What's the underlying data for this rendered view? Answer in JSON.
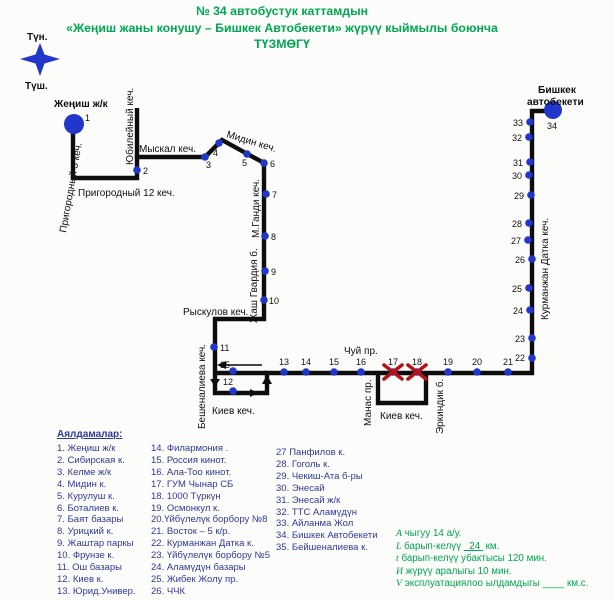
{
  "title": {
    "line1": "№ 34  автобустук каттамдын",
    "line2": "«Жеңиш жаны конушу – Бишкек Автобекети»  жүрүү кыймылы боюнча",
    "line3": "ТҮЗМӨГҮ"
  },
  "colors": {
    "green": "#00a651",
    "navy": "#2e3a98",
    "blue": "#2236cb",
    "ink": "#0d0d0d",
    "red": "#b5121b",
    "bg": "#fcfcfa"
  },
  "map": {
    "compass": {
      "north": "Түн.",
      "south": "Түш.",
      "nx": 27,
      "ny": 40,
      "sx": 25,
      "sy": 89,
      "star": "40,43 44.5,54.5 60,59 44.5,63.5 40,76 35.5,63.5 20,59 35.5,54.5"
    },
    "route_path": "M73,123 L73,178 L137,178 L137,157 L205,157 L222,140 L264,163 L264,319 L215,319 L215,393 L267,393 L267,373 L532,373 L532,111 L553,111",
    "street_segments": [
      "M137,108 L137,158",
      "M215,373 L267,373",
      "M378,373 L378,403 L426,403 L426,373"
    ],
    "thin_lines": [
      "M224,365 L262,365"
    ],
    "arrows": [
      {
        "points": "217,365 226,361 226,369",
        "name": "arrow-west-icon"
      },
      {
        "points": "215,387 210,379 220,379",
        "name": "arrow-south-icon"
      },
      {
        "points": "258,393 250,389 250,397",
        "name": "arrow-east-icon"
      },
      {
        "points": "267,375 262,384 272,384",
        "name": "arrow-north-icon"
      }
    ],
    "terminals": [
      {
        "n": "1",
        "x": 74,
        "y": 124,
        "r": 10,
        "nx": 85,
        "ny": 121,
        "a": "start"
      },
      {
        "n": "34",
        "x": 553,
        "y": 110,
        "r": 9,
        "nx": 552,
        "ny": 129,
        "a": "middle"
      }
    ],
    "stops": [
      {
        "n": "2",
        "x": 137,
        "y": 170,
        "nx": 143,
        "ny": 174,
        "a": "start"
      },
      {
        "n": "3",
        "x": 205,
        "y": 157,
        "nx": 206,
        "ny": 168,
        "a": "start"
      },
      {
        "n": "4",
        "x": 219,
        "y": 143,
        "nx": 213,
        "ny": 156,
        "a": "start"
      },
      {
        "n": "5",
        "x": 247,
        "y": 154,
        "nx": 242,
        "ny": 166,
        "a": "start"
      },
      {
        "n": "6",
        "x": 264,
        "y": 163,
        "nx": 270,
        "ny": 167,
        "a": "start"
      },
      {
        "n": "7",
        "x": 266,
        "y": 194,
        "nx": 272,
        "ny": 198,
        "a": "start"
      },
      {
        "n": "8",
        "x": 265,
        "y": 236,
        "nx": 271,
        "ny": 240,
        "a": "start"
      },
      {
        "n": "9",
        "x": 265,
        "y": 271,
        "nx": 271,
        "ny": 275,
        "a": "start"
      },
      {
        "n": "10",
        "x": 264,
        "y": 300,
        "nx": 269,
        "ny": 304,
        "a": "start"
      },
      {
        "n": "11",
        "x": 214,
        "y": 347,
        "nx": 220,
        "ny": 351,
        "a": "start"
      },
      {
        "n": "12",
        "x": 233,
        "y": 391,
        "nx": 223,
        "ny": 385,
        "a": "start"
      },
      {
        "n": "35",
        "x": 233,
        "y": 371,
        "nx": 220,
        "ny": 368,
        "a": "start"
      },
      {
        "n": "13",
        "x": 284,
        "y": 372,
        "nx": 284,
        "ny": 365,
        "a": "middle"
      },
      {
        "n": "14",
        "x": 306,
        "y": 372,
        "nx": 306,
        "ny": 365,
        "a": "middle"
      },
      {
        "n": "15",
        "x": 334,
        "y": 372,
        "nx": 334,
        "ny": 365,
        "a": "middle"
      },
      {
        "n": "16",
        "x": 361,
        "y": 372,
        "nx": 361,
        "ny": 365,
        "a": "middle"
      },
      {
        "n": "17",
        "x": 393,
        "y": 372,
        "nx": 393,
        "ny": 365,
        "a": "middle"
      },
      {
        "n": "18",
        "x": 417,
        "y": 372,
        "nx": 417,
        "ny": 365,
        "a": "middle"
      },
      {
        "n": "19",
        "x": 448,
        "y": 372,
        "nx": 448,
        "ny": 365,
        "a": "middle"
      },
      {
        "n": "20",
        "x": 477,
        "y": 372,
        "nx": 477,
        "ny": 365,
        "a": "middle"
      },
      {
        "n": "21",
        "x": 508,
        "y": 372,
        "nx": 508,
        "ny": 365,
        "a": "middle"
      },
      {
        "n": "22",
        "x": 532,
        "y": 358,
        "nx": 525,
        "ny": 361,
        "a": "end"
      },
      {
        "n": "23",
        "x": 532,
        "y": 338,
        "nx": 525,
        "ny": 342,
        "a": "end"
      },
      {
        "n": "24",
        "x": 530,
        "y": 310,
        "nx": 523,
        "ny": 314,
        "a": "end"
      },
      {
        "n": "25",
        "x": 529,
        "y": 288,
        "nx": 522,
        "ny": 292,
        "a": "end"
      },
      {
        "n": "26",
        "x": 532,
        "y": 259,
        "nx": 525,
        "ny": 263,
        "a": "end"
      },
      {
        "n": "27",
        "x": 528,
        "y": 240,
        "nx": 521,
        "ny": 244,
        "a": "end"
      },
      {
        "n": "28",
        "x": 529,
        "y": 223,
        "nx": 522,
        "ny": 227,
        "a": "end"
      },
      {
        "n": "29",
        "x": 531,
        "y": 195,
        "nx": 524,
        "ny": 199,
        "a": "end"
      },
      {
        "n": "30",
        "x": 529,
        "y": 175,
        "nx": 522,
        "ny": 179,
        "a": "end"
      },
      {
        "n": "31",
        "x": 530,
        "y": 162,
        "nx": 523,
        "ny": 166,
        "a": "end"
      },
      {
        "n": "32",
        "x": 529,
        "y": 137,
        "nx": 522,
        "ny": 141,
        "a": "end"
      },
      {
        "n": "33",
        "x": 530,
        "y": 122,
        "nx": 523,
        "ny": 126,
        "a": "end"
      }
    ],
    "crossed": [
      {
        "x": 393,
        "y": 372
      },
      {
        "x": 417,
        "y": 372
      }
    ],
    "street_labels": [
      {
        "t": "Жеңиш ж/к",
        "x": 54,
        "y": 107,
        "rot": 0,
        "bold": true
      },
      {
        "t": "Бишкек",
        "x": 538,
        "y": 93,
        "rot": 0,
        "bold": true
      },
      {
        "t": "автобекети",
        "x": 527,
        "y": 105,
        "rot": 0,
        "bold": true
      },
      {
        "t": "Пригородный 3 кеч.",
        "x": 66,
        "y": 233,
        "rot": -80,
        "bold": false
      },
      {
        "t": "Юбилейный кеч.",
        "x": 133,
        "y": 165,
        "rot": -90,
        "bold": false
      },
      {
        "t": "Пригородный 12 кеч.",
        "x": 78,
        "y": 196,
        "rot": 0,
        "bold": false
      },
      {
        "t": "Мыскал кеч.",
        "x": 139,
        "y": 152,
        "rot": 0,
        "bold": false
      },
      {
        "t": "Мидин кеч.",
        "x": 226,
        "y": 137,
        "rot": 17,
        "bold": false
      },
      {
        "t": "М.Ганди кеч.",
        "x": 259,
        "y": 238,
        "rot": -90,
        "bold": false
      },
      {
        "t": "Жаш Гвардия б.",
        "x": 257,
        "y": 323,
        "rot": -90,
        "bold": false
      },
      {
        "t": "Рыскулов кеч.",
        "x": 183,
        "y": 315,
        "rot": 0,
        "bold": false
      },
      {
        "t": "Бешеналиева кеч.",
        "x": 205,
        "y": 429,
        "rot": -90,
        "bold": false
      },
      {
        "t": "Киев кеч.",
        "x": 212,
        "y": 414,
        "rot": 0,
        "bold": false
      },
      {
        "t": "Чуй пр.",
        "x": 344,
        "y": 354,
        "rot": 0,
        "bold": false
      },
      {
        "t": "Манас пр.",
        "x": 371,
        "y": 426,
        "rot": -90,
        "bold": false
      },
      {
        "t": "Киев кеч.",
        "x": 380,
        "y": 419,
        "rot": 0,
        "bold": false
      },
      {
        "t": "Эркиндик б.",
        "x": 443,
        "y": 434,
        "rot": -90,
        "bold": false
      },
      {
        "t": "Курманжан Датка кеч.",
        "x": 548,
        "y": 320,
        "rot": -90,
        "bold": false
      }
    ]
  },
  "legend": {
    "header": "Аялдамалар:",
    "columns": [
      [
        "1. Жеңиш ж/к",
        "2. Сибирская к.",
        "3. Келме ж/к",
        "4. Мидин к.",
        "5. Курулуш к.",
        "6. Боталиев к.",
        "7. Баят базары",
        "8. Урицкий к.",
        "9. Жаштар паркы",
        "10. Фрунзе к.",
        "11. Ош базары",
        "12. Киев к.",
        "13. Юрид.Универ."
      ],
      [
        "14. Филармония .",
        "15. Россия кинот.",
        "16. Ала-Тоо кинот.",
        "17. ГУМ Чынар СБ",
        "18. 1000 Түркүн",
        "19. Осмонкул к.",
        "20.Үйбүлелүк борбору №8",
        "21. Восток – 5 к/р.",
        "22. Курманжан Датка к.",
        "23. Үйбүлелүк борбору №5",
        "24. Аламүдүн базары",
        "25. Жибек Жолу пр.",
        "26. ЧЧК"
      ],
      [
        "27 Панфилов к.",
        "28. Гоголь к.",
        "29. Чекиш-Ата б-ры",
        "30. Энесай",
        "31. Энесай ж/к",
        "32. ТТС Аламүдүн",
        "33. Айланма Жол",
        "34. Бишкек Автобекети",
        "35. Бейшеналиева к."
      ]
    ]
  },
  "stats_lines": [
    [
      {
        "t": "А",
        "var": true
      },
      {
        "t": " чыгуу 14 а/у."
      }
    ],
    [
      {
        "t": "L",
        "var": true
      },
      {
        "t": " барып-келүү "
      },
      {
        "t": "  24 ",
        "u": true
      },
      {
        "t": " км."
      }
    ],
    [
      {
        "t": "t",
        "var": true
      },
      {
        "t": " барып-келүү убактысы 120 мин."
      }
    ],
    [
      {
        "t": "И",
        "var": true
      },
      {
        "t": " жүрүү аралыгы  10  мин."
      }
    ],
    [
      {
        "t": "V",
        "var": true
      },
      {
        "t": " эксплуатациялоо ылдамдыгы ____ км.с."
      }
    ]
  ]
}
